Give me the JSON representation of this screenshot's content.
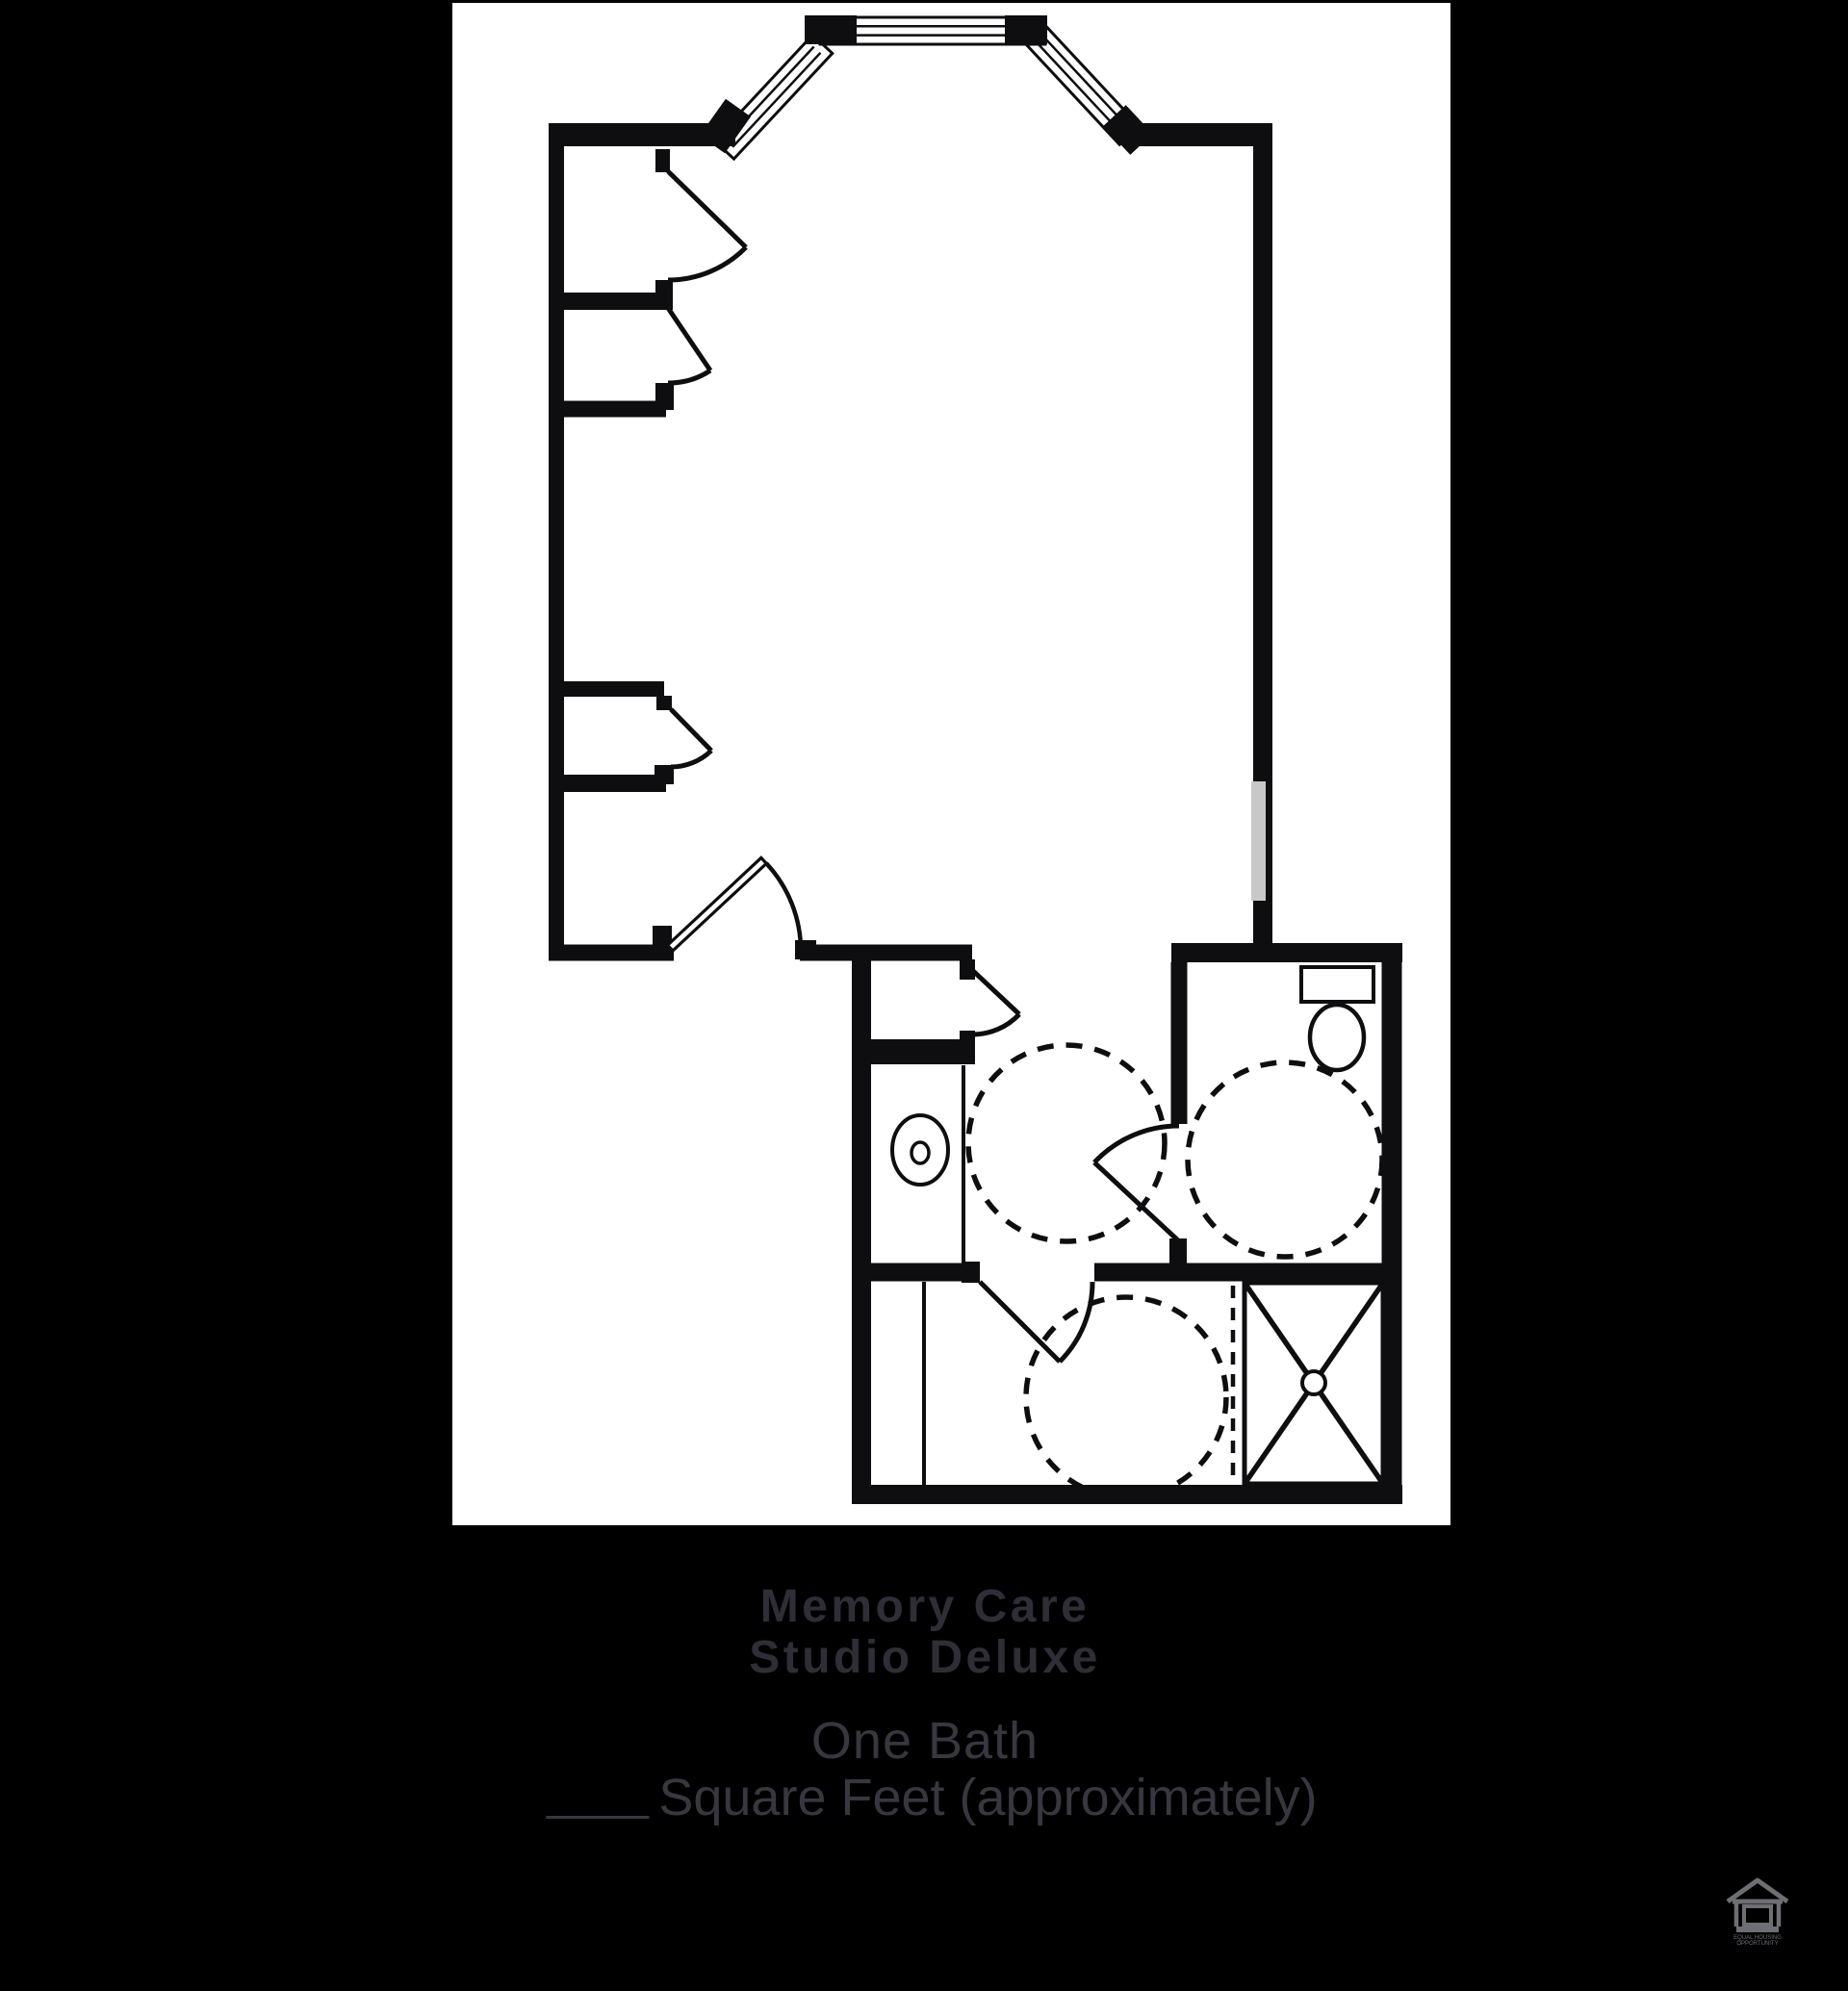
{
  "page": {
    "background": "#000000",
    "panel_background": "#ffffff"
  },
  "floor_plan": {
    "type": "floor-plan-drawing",
    "line_color": "#0e0e10",
    "wall_window_color": "#c8c8c8",
    "windows_count": 3,
    "doors_count": 7,
    "turning_circles_count": 3,
    "features": [
      "bay-window",
      "closet-doors",
      "entry-door",
      "vestibule-door",
      "vanity-sink",
      "toilet",
      "roll-in-shower",
      "accessible-turning-circles"
    ]
  },
  "caption": {
    "title_line1": "Memory Care",
    "title_line2": "Studio Deluxe",
    "bath": "One Bath",
    "square_feet": "Square Feet (approximately)",
    "square_feet_value": "",
    "title_color": "#2f2e37",
    "subtitle_color": "#38373f"
  },
  "footer": {
    "equal_housing_line1": "EQUAL HOUSING",
    "equal_housing_line2": "OPPORTUNITY",
    "icon_color": "#6e6e75"
  }
}
